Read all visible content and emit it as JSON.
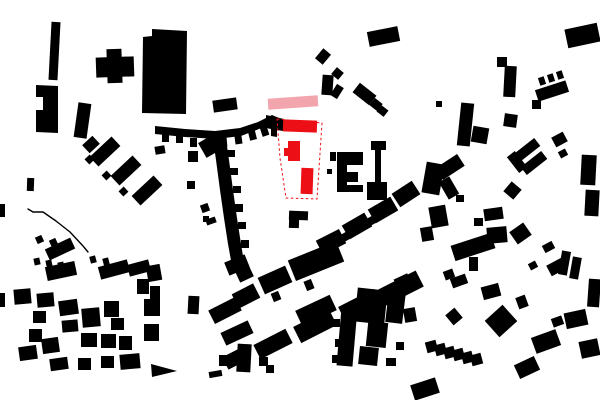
{
  "figure": {
    "kind": "figure-ground-site-plan",
    "canvas": {
      "width": 600,
      "height": 400,
      "background": "#ffffff"
    },
    "colors": {
      "context_building": "#000000",
      "site_highlight": "#ec1016",
      "proposed_bar": "#f3a5ad",
      "site_boundary_line": "#ec1016"
    },
    "context_buildings": {
      "rects": [
        [
          50,
          22,
          9,
          58,
          3
        ],
        [
          96,
          57,
          38,
          20,
          -2
        ],
        [
          107,
          49,
          15,
          34,
          -2
        ],
        [
          76,
          103,
          13,
          35,
          8
        ],
        [
          213,
          99,
          24,
          12,
          -8
        ],
        [
          27,
          178,
          7,
          13,
          2
        ],
        [
          0,
          204,
          5,
          13,
          0
        ],
        [
          368,
          29,
          31,
          15,
          -11
        ],
        [
          318,
          50,
          10,
          13,
          40
        ],
        [
          333,
          69,
          9,
          9,
          40
        ],
        [
          322,
          75,
          11,
          20,
          4
        ],
        [
          333,
          85,
          8,
          13,
          32
        ],
        [
          354,
          88,
          21,
          12,
          38
        ],
        [
          371,
          100,
          10,
          9,
          38
        ],
        [
          378,
          107,
          9,
          8,
          38
        ],
        [
          566,
          26,
          33,
          19,
          -12
        ],
        [
          497,
          57,
          10,
          10,
          0
        ],
        [
          504,
          66,
          12,
          31,
          3
        ],
        [
          436,
          101,
          6,
          6,
          0
        ],
        [
          459,
          103,
          13,
          43,
          6
        ],
        [
          472,
          127,
          16,
          16,
          10
        ],
        [
          504,
          114,
          13,
          13,
          8
        ],
        [
          532,
          100,
          9,
          9,
          0
        ],
        [
          536,
          85,
          32,
          12,
          -18
        ],
        [
          539,
          77,
          6,
          8,
          -18
        ],
        [
          548,
          74,
          6,
          8,
          -18
        ],
        [
          557,
          71,
          6,
          8,
          -18
        ],
        [
          553,
          134,
          13,
          11,
          -28
        ],
        [
          559,
          150,
          8,
          7,
          -28
        ],
        [
          514,
          145,
          26,
          10,
          -38
        ],
        [
          521,
          158,
          26,
          10,
          -38
        ],
        [
          512,
          152,
          10,
          20,
          -38
        ],
        [
          424,
          163,
          18,
          31,
          10
        ],
        [
          443,
          178,
          12,
          20,
          -30
        ],
        [
          506,
          184,
          13,
          13,
          40
        ],
        [
          456,
          195,
          8,
          7,
          0
        ],
        [
          430,
          206,
          17,
          21,
          -10
        ],
        [
          421,
          227,
          12,
          14,
          -10
        ],
        [
          484,
          208,
          19,
          12,
          -8
        ],
        [
          474,
          218,
          9,
          8,
          0
        ],
        [
          487,
          227,
          20,
          16,
          -5
        ],
        [
          512,
          226,
          17,
          15,
          -35
        ],
        [
          452,
          239,
          42,
          16,
          -18
        ],
        [
          469,
          257,
          9,
          14,
          0
        ],
        [
          543,
          243,
          11,
          8,
          -28
        ],
        [
          548,
          261,
          17,
          12,
          -28
        ],
        [
          529,
          262,
          8,
          7,
          -28
        ],
        [
          581,
          155,
          15,
          30,
          3
        ],
        [
          585,
          190,
          14,
          26,
          3
        ],
        [
          560,
          251,
          9,
          24,
          10
        ],
        [
          571,
          257,
          9,
          22,
          10
        ],
        [
          588,
          279,
          12,
          28,
          4
        ],
        [
          565,
          311,
          22,
          16,
          -12
        ],
        [
          580,
          340,
          19,
          17,
          -12
        ],
        [
          394,
          186,
          24,
          16,
          -33
        ],
        [
          370,
          202,
          26,
          16,
          -30
        ],
        [
          344,
          218,
          26,
          16,
          -30
        ],
        [
          318,
          234,
          26,
          16,
          -27
        ],
        [
          290,
          250,
          52,
          22,
          -22
        ],
        [
          260,
          271,
          30,
          18,
          -24
        ],
        [
          234,
          288,
          24,
          16,
          -27
        ],
        [
          210,
          303,
          30,
          15,
          -27
        ],
        [
          305,
          280,
          8,
          10,
          -22
        ],
        [
          272,
          292,
          8,
          9,
          -22
        ],
        [
          341,
          233,
          8,
          8,
          -30
        ],
        [
          367,
          217,
          8,
          8,
          -30
        ],
        [
          380,
          279,
          42,
          18,
          -27
        ],
        [
          340,
          297,
          40,
          18,
          -27
        ],
        [
          295,
          317,
          40,
          18,
          -27
        ],
        [
          255,
          336,
          36,
          16,
          -27
        ],
        [
          224,
          351,
          24,
          14,
          -27
        ],
        [
          297,
          302,
          38,
          17,
          -25
        ],
        [
          437,
          160,
          26,
          14,
          -33
        ],
        [
          330,
          152,
          6,
          9,
          0
        ],
        [
          327,
          169,
          5,
          5,
          0
        ],
        [
          289,
          211,
          19,
          9,
          2
        ],
        [
          289,
          218,
          10,
          10,
          2
        ],
        [
          162,
          134,
          7,
          8,
          0
        ],
        [
          176,
          136,
          7,
          7,
          0
        ],
        [
          190,
          138,
          7,
          9,
          0
        ],
        [
          205,
          139,
          7,
          8,
          0
        ],
        [
          220,
          138,
          7,
          9,
          -5
        ],
        [
          235,
          136,
          7,
          8,
          -8
        ],
        [
          249,
          131,
          7,
          9,
          -14
        ],
        [
          261,
          126,
          7,
          10,
          -18
        ],
        [
          201,
          137,
          20,
          17,
          -30
        ],
        [
          227,
          150,
          8,
          7,
          0
        ],
        [
          230,
          168,
          8,
          7,
          0
        ],
        [
          233,
          186,
          8,
          7,
          0
        ],
        [
          235,
          204,
          8,
          8,
          0
        ],
        [
          238,
          222,
          8,
          7,
          0
        ],
        [
          241,
          240,
          8,
          8,
          0
        ],
        [
          226,
          258,
          22,
          14,
          -22
        ],
        [
          237,
          268,
          15,
          12,
          -25
        ],
        [
          201,
          204,
          8,
          8,
          -20
        ],
        [
          206,
          218,
          10,
          6,
          -20
        ],
        [
          188,
          151,
          10,
          11,
          0
        ],
        [
          155,
          146,
          10,
          8,
          -10
        ],
        [
          187,
          181,
          8,
          8,
          0
        ],
        [
          203,
          216,
          6,
          6,
          0
        ],
        [
          84,
          139,
          14,
          11,
          -43
        ],
        [
          90,
          145,
          30,
          13,
          -43
        ],
        [
          111,
          164,
          30,
          13,
          -43
        ],
        [
          132,
          184,
          30,
          13,
          -43
        ],
        [
          86,
          156,
          7,
          7,
          -43
        ],
        [
          103,
          172,
          7,
          7,
          -43
        ],
        [
          120,
          188,
          7,
          7,
          -43
        ],
        [
          46,
          243,
          28,
          12,
          -25
        ],
        [
          36,
          236,
          7,
          7,
          -25
        ],
        [
          50,
          239,
          7,
          7,
          -25
        ],
        [
          46,
          264,
          30,
          14,
          -12
        ],
        [
          34,
          258,
          6,
          7,
          -12
        ],
        [
          46,
          260,
          6,
          7,
          -12
        ],
        [
          58,
          262,
          6,
          7,
          -12
        ],
        [
          99,
          263,
          30,
          13,
          -15
        ],
        [
          90,
          256,
          6,
          7,
          -15
        ],
        [
          103,
          258,
          6,
          7,
          -15
        ],
        [
          128,
          262,
          22,
          12,
          -15
        ],
        [
          147,
          265,
          14,
          16,
          -10
        ],
        [
          137,
          279,
          12,
          15,
          0
        ],
        [
          150,
          286,
          10,
          13,
          0
        ],
        [
          14,
          289,
          17,
          15,
          -5
        ],
        [
          37,
          293,
          17,
          14,
          -5
        ],
        [
          59,
          300,
          19,
          15,
          -8
        ],
        [
          33,
          311,
          13,
          12,
          0
        ],
        [
          62,
          320,
          16,
          12,
          -5
        ],
        [
          82,
          308,
          18,
          19,
          -5
        ],
        [
          104,
          301,
          15,
          16,
          0
        ],
        [
          111,
          318,
          13,
          12,
          0
        ],
        [
          81,
          333,
          16,
          14,
          0
        ],
        [
          101,
          334,
          15,
          14,
          0
        ],
        [
          119,
          336,
          13,
          14,
          0
        ],
        [
          42,
          338,
          17,
          15,
          -8
        ],
        [
          19,
          346,
          18,
          14,
          -8
        ],
        [
          50,
          358,
          18,
          12,
          -8
        ],
        [
          78,
          358,
          13,
          12,
          0
        ],
        [
          101,
          356,
          13,
          12,
          0
        ],
        [
          120,
          354,
          20,
          15,
          -5
        ],
        [
          144,
          299,
          16,
          17,
          0
        ],
        [
          144,
          324,
          15,
          17,
          0
        ],
        [
          29,
          329,
          13,
          13,
          0
        ],
        [
          0,
          293,
          5,
          14,
          0
        ],
        [
          188,
          296,
          11,
          18,
          3
        ],
        [
          222,
          326,
          30,
          14,
          -25
        ],
        [
          219,
          355,
          12,
          11,
          0
        ],
        [
          209,
          371,
          13,
          6,
          -10
        ],
        [
          237,
          344,
          14,
          28,
          3
        ],
        [
          259,
          357,
          9,
          9,
          0
        ],
        [
          266,
          365,
          8,
          8,
          0
        ],
        [
          356,
          289,
          30,
          34,
          6
        ],
        [
          367,
          322,
          20,
          25,
          6
        ],
        [
          359,
          347,
          19,
          18,
          6
        ],
        [
          339,
          308,
          16,
          58,
          5
        ],
        [
          333,
          319,
          7,
          8,
          0
        ],
        [
          335,
          339,
          7,
          8,
          0
        ],
        [
          332,
          355,
          7,
          8,
          0
        ],
        [
          387,
          292,
          17,
          31,
          7
        ],
        [
          395,
          276,
          15,
          10,
          -25
        ],
        [
          404,
          308,
          12,
          14,
          -10
        ],
        [
          396,
          342,
          8,
          8,
          0
        ],
        [
          386,
          358,
          10,
          8,
          0
        ],
        [
          412,
          381,
          26,
          16,
          -18
        ],
        [
          426,
          341,
          11,
          11,
          -15
        ],
        [
          435,
          344,
          11,
          11,
          -15
        ],
        [
          444,
          347,
          11,
          11,
          -15
        ],
        [
          453,
          349,
          11,
          11,
          -15
        ],
        [
          462,
          352,
          11,
          11,
          -15
        ],
        [
          471,
          354,
          11,
          11,
          -15
        ],
        [
          444,
          270,
          10,
          9,
          -20
        ],
        [
          448,
          310,
          12,
          13,
          -40
        ],
        [
          489,
          310,
          24,
          22,
          -42
        ],
        [
          517,
          296,
          10,
          12,
          -20
        ],
        [
          482,
          285,
          18,
          13,
          -15
        ],
        [
          451,
          276,
          16,
          10,
          -20
        ],
        [
          533,
          333,
          26,
          17,
          -20
        ],
        [
          552,
          317,
          11,
          9,
          -20
        ],
        [
          516,
          360,
          22,
          15,
          -25
        ],
        [
          543,
          336,
          12,
          10,
          -20
        ]
      ],
      "polygons": [
        "152,29 187,31 186,114 142,113 143,37 152,36",
        "36,85 58,86 58,133 36,132 36,110 43,110 43,97 36,97",
        "337,152 363,152 363,165 347,165 347,172 358,172 358,182 347,182 347,185 363,185 363,192 337,192",
        "371,141 386,141 386,150 381,150 381,182 387,182 387,200 367,200 367,182 375,182 375,150 371,150",
        "155,126 185,129 215,131 240,128 258,122 272,115 279,118 273,123 259,129 241,136 216,139 185,137 155,134",
        "266,115 284,119 283,131 277,130 277,137 271,136 271,129 266,128",
        "212,132 225,132 229,160 233,190 237,218 241,244 244,262 232,266 228,244 224,218 220,190 216,160",
        "151,364 177,371 152,377"
      ],
      "polylines": [
        {
          "points": "28,209 33,212 43,212 56,221 70,232 83,246 88,252",
          "width": 1.4
        }
      ]
    },
    "proposed_bar": {
      "rect": [
        268,
        97,
        50,
        11,
        -4
      ]
    },
    "site": {
      "boundary_points": "277,119 322,123 317,199 286,198 280,158",
      "boundary_stroke_width": 1,
      "boundary_dash": "2.5 2.5",
      "buildings": {
        "rects": [
          [
            283,
            120,
            34,
            12,
            2
          ],
          [
            301,
            168,
            12,
            26,
            2
          ]
        ],
        "polygons": [
          "288,141 300,141 300,161 288,161 288,156 284,156 284,148 288,148"
        ]
      }
    }
  }
}
